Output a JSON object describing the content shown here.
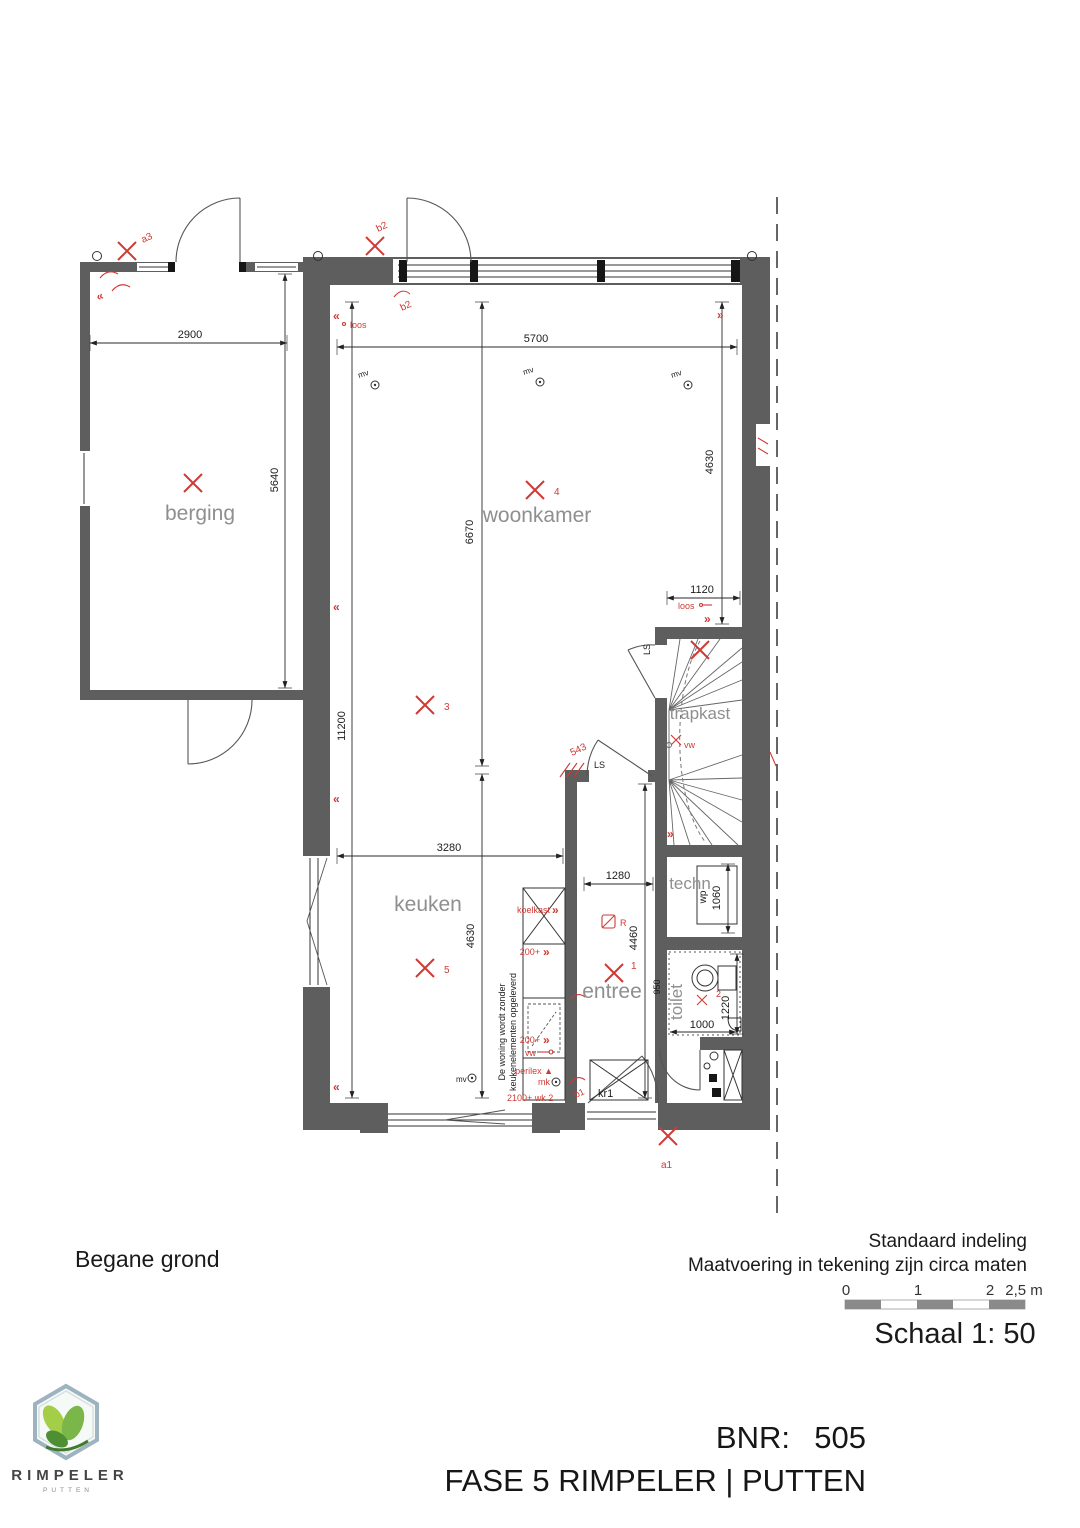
{
  "colors": {
    "wall": "#5e5e5e",
    "red": "#cf3a34",
    "room_label": "#8f8f8f",
    "logo_green": "#7ab648"
  },
  "floorplan": {
    "rooms": {
      "berging": "berging",
      "woonkamer": "woonkamer",
      "keuken": "keuken",
      "entree": "entree",
      "trapkast": "trapkast",
      "techn": "techn",
      "toilet": "toilet",
      "kr1": "kr1",
      "wp": "wp"
    },
    "dims": {
      "w2900": "2900",
      "d5640": "5640",
      "w5700": "5700",
      "h6670": "6670",
      "h4630r": "4630",
      "w1120": "1120",
      "h11200": "11200",
      "w3280": "3280",
      "w1280": "1280",
      "h4460": "4460",
      "h4630k": "4630",
      "d1060": "1060",
      "d1220": "1220",
      "w1000": "1000",
      "d950": "950",
      "d543": "543"
    },
    "annot": {
      "a3": "a3",
      "b2": "b2",
      "b1": "b1",
      "a1": "a1",
      "p1": "1",
      "p2": "2",
      "p3": "3",
      "p4": "4",
      "p5": "5",
      "loos": "loos",
      "mv": "mv",
      "ls": "LS",
      "vw": "vw",
      "rook": "R",
      "koelkast": "koelkast",
      "s200": "200+",
      "perilex": "perilex ▲",
      "mk": "mk",
      "wk": "2100+ wk 2",
      "note1": "De woning wordt zonder",
      "note2": "keukenelementen opgeleverd"
    },
    "symbols": {
      "chev_left": "«",
      "chev_right": "»"
    }
  },
  "legend": {
    "floor_label": "Begane grond",
    "note1": "Standaard indeling",
    "note2": "Maatvoering in tekening zijn circa maten",
    "schaal": "Schaal 1: 50",
    "t0": "0",
    "t1": "1",
    "t2": "2",
    "t25": "2,5 m"
  },
  "title": {
    "bnr_label": "BNR:",
    "bnr_value": "505",
    "project": "FASE 5 RIMPELER | PUTTEN"
  },
  "logo": {
    "name": "RIMPELER",
    "city": "PUTTEN"
  }
}
